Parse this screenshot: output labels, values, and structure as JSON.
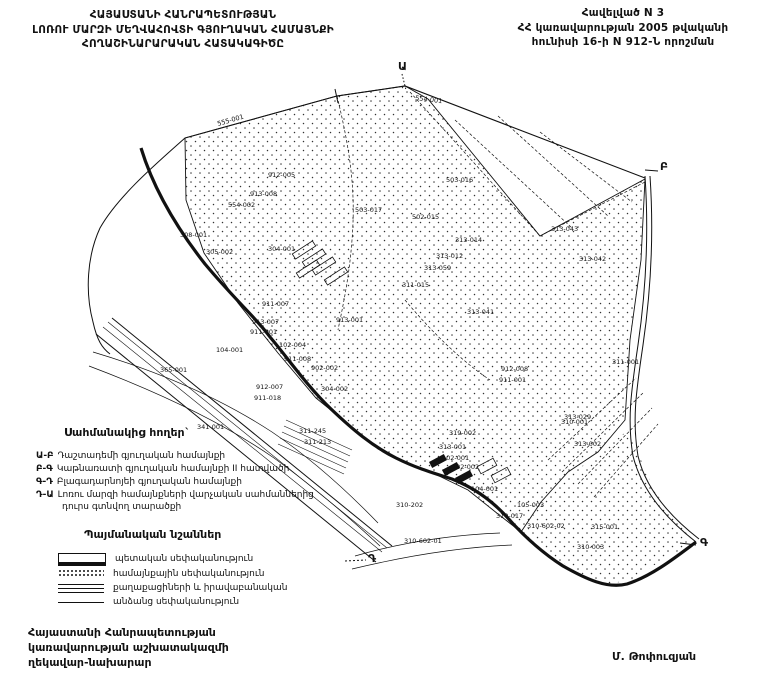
{
  "header": {
    "left": [
      "ՀԱՅԱՍՏԱՆԻ ՀԱՆՐԱՊԵՏՈՒԹՅԱՆ",
      "ԼՈՌՈՒ ՄԱՐԶԻ ՄԵՂՎԱՀՈՎՏԻ ԳՅՈՒՂԱԿԱՆ ՀԱՄԱՅՆՔԻ",
      "ՀՈՂԱՇԻՆԱՐԱՐԱԿԱՆ ՀԱՏԱԿԱԳԻԾԸ"
    ],
    "right": [
      "Հավելված N 3",
      "ՀՀ կառավարության 2005 թվականի",
      "հունիսի 16-ի N 912-Ն որոշման"
    ]
  },
  "map": {
    "corners": [
      {
        "x": 398,
        "y": 70,
        "label": "Ա"
      },
      {
        "x": 660,
        "y": 170,
        "label": "Բ"
      },
      {
        "x": 700,
        "y": 546,
        "label": "Գ"
      },
      {
        "x": 368,
        "y": 562,
        "label": "Դ"
      }
    ],
    "parcels": [
      {
        "x": 218,
        "y": 126,
        "label": "555-001",
        "r": -16
      },
      {
        "x": 415,
        "y": 100,
        "label": "554-001",
        "r": 7
      },
      {
        "x": 268,
        "y": 177,
        "label": "912-005"
      },
      {
        "x": 250,
        "y": 196,
        "label": "913-008"
      },
      {
        "x": 228,
        "y": 207,
        "label": "554-002"
      },
      {
        "x": 180,
        "y": 237,
        "label": "308-001"
      },
      {
        "x": 206,
        "y": 254,
        "label": "305-002"
      },
      {
        "x": 268,
        "y": 251,
        "label": "304-001"
      },
      {
        "x": 355,
        "y": 212,
        "label": "503-017"
      },
      {
        "x": 446,
        "y": 182,
        "label": "503-016"
      },
      {
        "x": 412,
        "y": 219,
        "label": "502-015"
      },
      {
        "x": 455,
        "y": 242,
        "label": "313-014"
      },
      {
        "x": 436,
        "y": 258,
        "label": "313-012"
      },
      {
        "x": 424,
        "y": 270,
        "label": "313-059"
      },
      {
        "x": 402,
        "y": 287,
        "label": "311-015"
      },
      {
        "x": 551,
        "y": 231,
        "label": "313-043"
      },
      {
        "x": 579,
        "y": 261,
        "label": "313-042"
      },
      {
        "x": 467,
        "y": 314,
        "label": "313-041"
      },
      {
        "x": 262,
        "y": 306,
        "label": "911-007"
      },
      {
        "x": 252,
        "y": 324,
        "label": "913-007"
      },
      {
        "x": 250,
        "y": 334,
        "label": "911-001"
      },
      {
        "x": 336,
        "y": 322,
        "label": "913-001"
      },
      {
        "x": 279,
        "y": 347,
        "label": "102-004"
      },
      {
        "x": 216,
        "y": 352,
        "label": "104-001"
      },
      {
        "x": 160,
        "y": 372,
        "label": "365-001"
      },
      {
        "x": 284,
        "y": 361,
        "label": "911-008"
      },
      {
        "x": 311,
        "y": 370,
        "label": "902-002"
      },
      {
        "x": 256,
        "y": 389,
        "label": "912-007"
      },
      {
        "x": 254,
        "y": 400,
        "label": "911-018"
      },
      {
        "x": 321,
        "y": 391,
        "label": "304-002"
      },
      {
        "x": 197,
        "y": 429,
        "label": "341-001"
      },
      {
        "x": 299,
        "y": 433,
        "label": "311-245"
      },
      {
        "x": 304,
        "y": 444,
        "label": "311-213"
      },
      {
        "x": 501,
        "y": 371,
        "label": "912-008"
      },
      {
        "x": 499,
        "y": 382,
        "label": "911-001"
      },
      {
        "x": 612,
        "y": 364,
        "label": "311-001"
      },
      {
        "x": 564,
        "y": 419,
        "label": "313-029"
      },
      {
        "x": 561,
        "y": 424,
        "label": "310-001"
      },
      {
        "x": 449,
        "y": 435,
        "label": "319-002"
      },
      {
        "x": 439,
        "y": 449,
        "label": "313-001"
      },
      {
        "x": 442,
        "y": 460,
        "label": "102-001"
      },
      {
        "x": 452,
        "y": 469,
        "label": "102-002"
      },
      {
        "x": 471,
        "y": 491,
        "label": "104-001"
      },
      {
        "x": 517,
        "y": 507,
        "label": "105-003"
      },
      {
        "x": 396,
        "y": 507,
        "label": "310-202"
      },
      {
        "x": 496,
        "y": 518,
        "label": "310-017"
      },
      {
        "x": 404,
        "y": 543,
        "label": "310-602-01"
      },
      {
        "x": 527,
        "y": 528,
        "label": "310-602-02"
      },
      {
        "x": 574,
        "y": 446,
        "label": "313-002"
      },
      {
        "x": 591,
        "y": 529,
        "label": "315-001"
      },
      {
        "x": 577,
        "y": 549,
        "label": "310-003"
      }
    ]
  },
  "legend_adjacent": {
    "title": "Սահմանակից հողեր`",
    "items": [
      {
        "code": "Ա-Բ",
        "text": "Դաշտադեմի գյուղական համայնքի"
      },
      {
        "code": "Բ-Գ",
        "text": "Կաթնառատի գյուղական համայնքի II հատվածի"
      },
      {
        "code": "Գ-Դ",
        "text": "Բլագադարնոյեի գյուղական համայնքի"
      },
      {
        "code": "Դ-Ա",
        "text": "Լոռու մարզի համայնքների վարչական սահմաններից դուրս գտնվող տարածքի"
      }
    ]
  },
  "legend_signs": {
    "title": "Պայմանական նշաններ",
    "items": [
      {
        "label": "պետական սեփականություն"
      },
      {
        "label": "համայնքային սեփականություն"
      },
      {
        "label": "քաղաքացիների և իրավաբանական"
      },
      {
        "label": "անձանց սեփականություն"
      }
    ]
  },
  "footer": {
    "left": [
      "Հայաստանի Հանրապետության",
      "կառավարության աշխատակազմի",
      "ղեկավար-նախարար"
    ],
    "right": "Մ. Թոփուզյան"
  },
  "colors": {
    "ink": "#111111",
    "paper": "#ffffff"
  }
}
